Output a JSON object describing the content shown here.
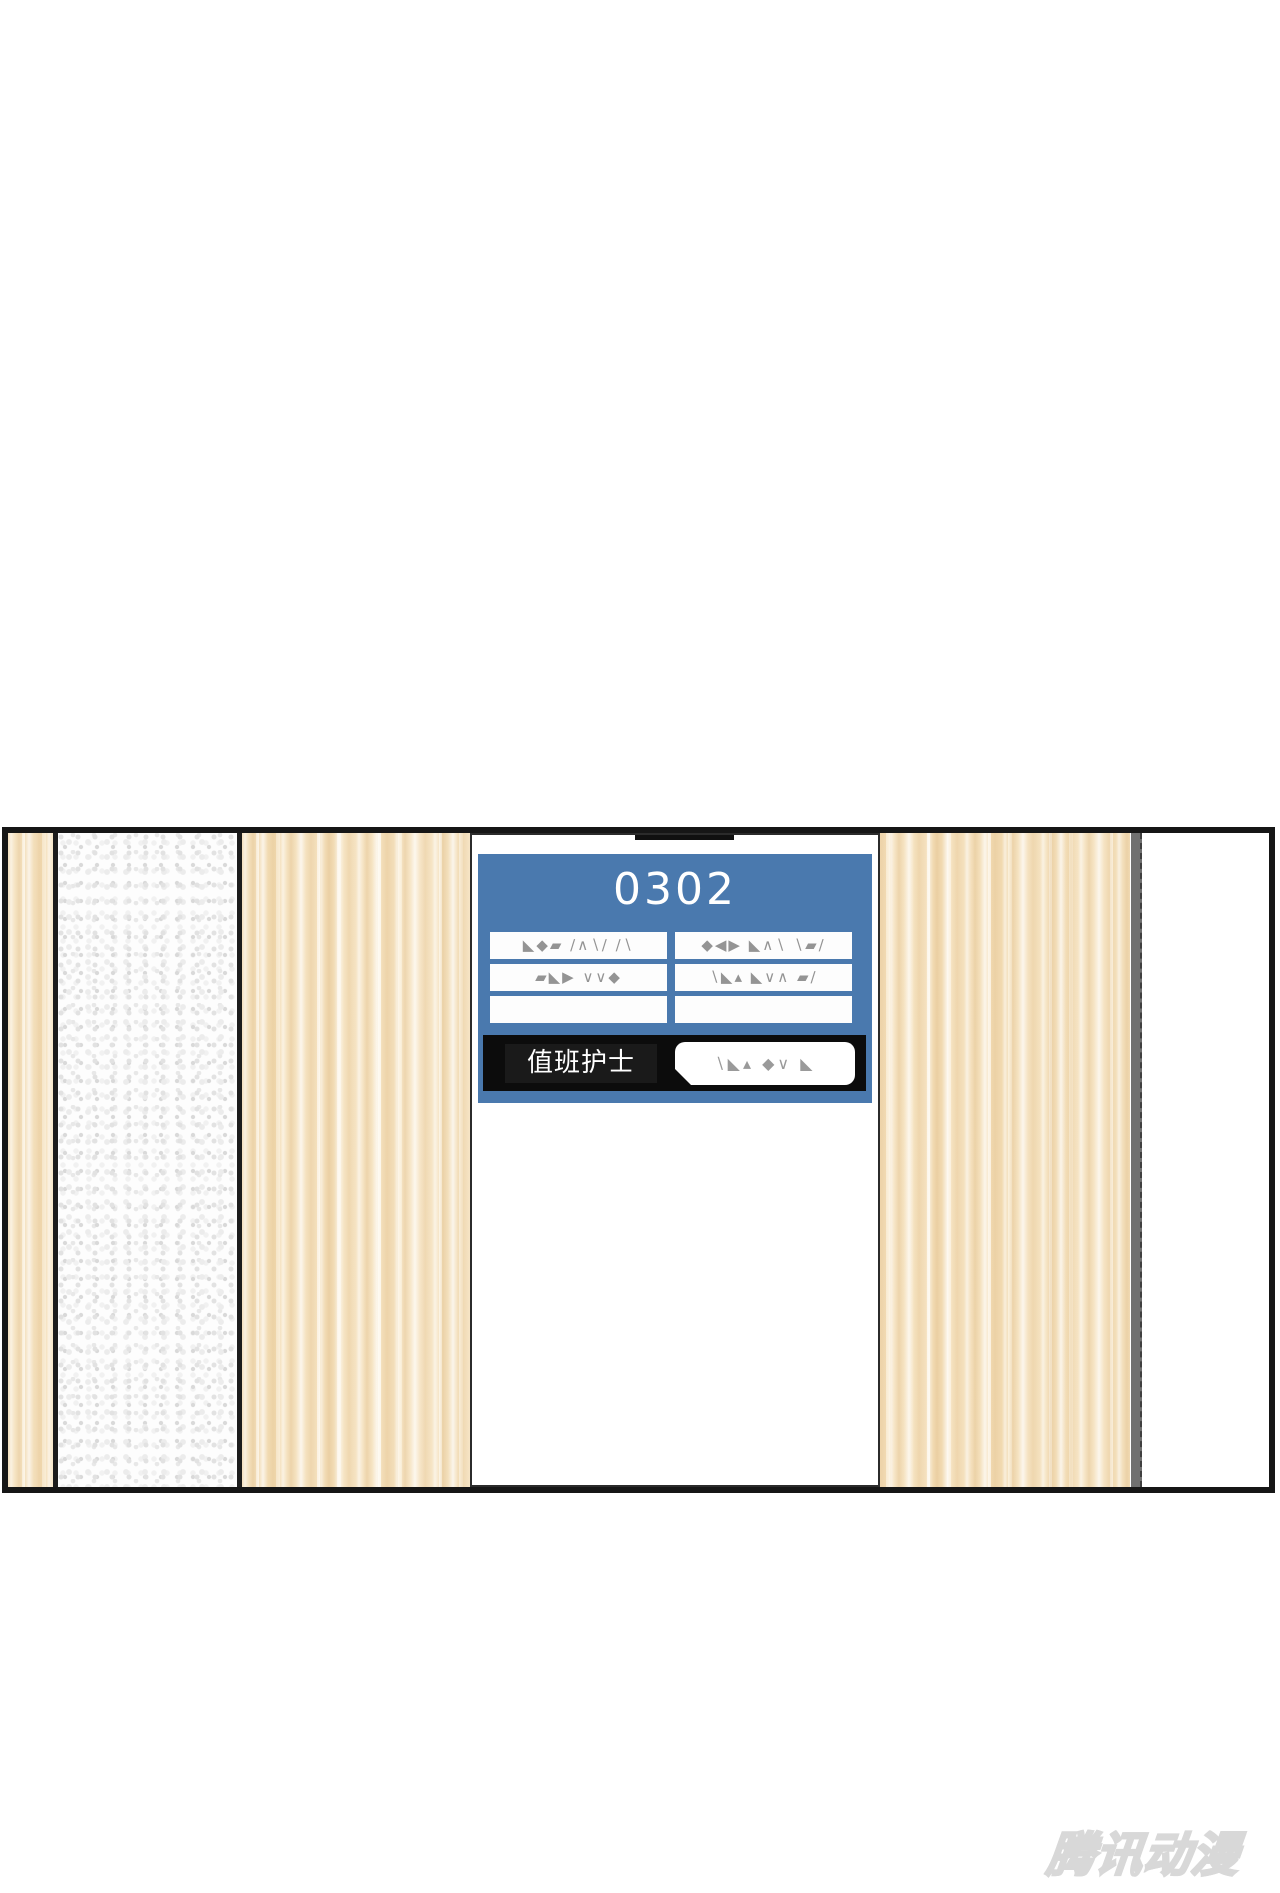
{
  "canvas": {
    "width": 1280,
    "height": 1893,
    "background": "#ffffff"
  },
  "panel": {
    "border_color": "#161616",
    "wood_base_color": "#f4e2c2",
    "speckle_base_color": "#fdfdfd",
    "divider_color": "#1c1c1c",
    "door_frame_color": "#707070",
    "right_wall_color": "#ffffff"
  },
  "room_sign": {
    "room_number": "0302",
    "accent_color": "#4a79ae",
    "frame_color": "#ffffff",
    "info_rows": [
      {
        "left": "◣◆▰ ∕∧∖∕ ∕∖",
        "right": "◆◀▶ ◣∧∖ ∖▰∕"
      },
      {
        "left": "▰◣▶ ∨∨◆",
        "right": "∖◣▴ ◣∨∧ ▰∕"
      },
      {
        "left": "",
        "right": ""
      }
    ],
    "duty_label": "值班护士",
    "duty_name": "∖◣▴ ◆∨ ◣"
  },
  "watermark": {
    "text": "腾讯动漫",
    "color": "#d8d8d8"
  }
}
